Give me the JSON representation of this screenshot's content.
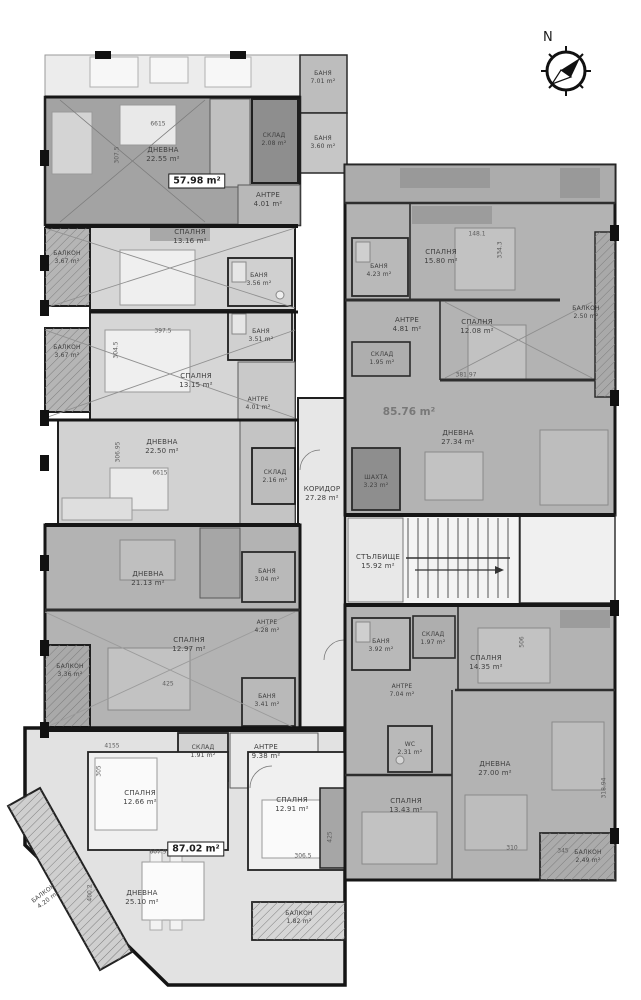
{
  "compass": {
    "label": "N"
  },
  "apartment_totals": [
    {
      "area": "57.98 m²"
    },
    {
      "area": "85.76 m²"
    },
    {
      "area": "87.02 m²"
    }
  ],
  "rooms": [
    {
      "name": "ДНЕВНА",
      "area": "22.55 m²"
    },
    {
      "name": "СКЛАД",
      "area": "2.08 m²"
    },
    {
      "name": "АНТРЕ",
      "area": "4.01 m²"
    },
    {
      "name": "БАНЯ",
      "area": "7.01 m²"
    },
    {
      "name": "БАНЯ",
      "area": "3.60 m²"
    },
    {
      "name": "БАЛКОН",
      "area": "3.67 m²"
    },
    {
      "name": "СПАЛНЯ",
      "area": "13.16 m²"
    },
    {
      "name": "БАНЯ",
      "area": "3.56 m²"
    },
    {
      "name": "БАНЯ",
      "area": "3.51 m²"
    },
    {
      "name": "БАЛКОН",
      "area": "3.67 m²"
    },
    {
      "name": "СПАЛНЯ",
      "area": "13.15 m²"
    },
    {
      "name": "АНТРЕ",
      "area": "4.01 m²"
    },
    {
      "name": "ДНЕВНА",
      "area": "22.50 m²"
    },
    {
      "name": "СКЛАД",
      "area": "2.16 m²"
    },
    {
      "name": "КОРИДОР",
      "area": "27.28 m²"
    },
    {
      "name": "БАНЯ",
      "area": "4.23 m²"
    },
    {
      "name": "СПАЛНЯ",
      "area": "15.80 m²"
    },
    {
      "name": "АНТРЕ",
      "area": "4.81 m²"
    },
    {
      "name": "СПАЛНЯ",
      "area": "12.08 m²"
    },
    {
      "name": "СКЛАД",
      "area": "1.95 m²"
    },
    {
      "name": "БАЛКОН",
      "area": "2.50 m²"
    },
    {
      "name": "ДНЕВНА",
      "area": "27.34 m²"
    },
    {
      "name": "ШАХТА",
      "area": "3.23 m²"
    },
    {
      "name": "СТЪЛБИЩЕ",
      "area": "15.92 m²"
    },
    {
      "name": "ДНЕВНА",
      "area": "21.13 m²"
    },
    {
      "name": "БАНЯ",
      "area": "3.04 m²"
    },
    {
      "name": "АНТРЕ",
      "area": "4.28 m²"
    },
    {
      "name": "СПАЛНЯ",
      "area": "12.97 m²"
    },
    {
      "name": "БАЛКОН",
      "area": "3.36 m²"
    },
    {
      "name": "БАНЯ",
      "area": "3.41 m²"
    },
    {
      "name": "СКЛАД",
      "area": "1.91 m²"
    },
    {
      "name": "АНТРЕ",
      "area": "9.38 m²"
    },
    {
      "name": "СПАЛНЯ",
      "area": "12.66 m²"
    },
    {
      "name": "ДНЕВНА",
      "area": "25.10 m²"
    },
    {
      "name": "БАЛКОН",
      "area": "4.20 m²"
    },
    {
      "name": "СПАЛНЯ",
      "area": "12.91 m²"
    },
    {
      "name": "БАЛКОН",
      "area": "1.82 m²"
    },
    {
      "name": "БАНЯ",
      "area": "3.92 m²"
    },
    {
      "name": "СКЛАД",
      "area": "1.97 m²"
    },
    {
      "name": "СПАЛНЯ",
      "area": "14.35 m²"
    },
    {
      "name": "АНТРЕ",
      "area": "7.04 m²"
    },
    {
      "name": "WC",
      "area": "2.31 m²"
    },
    {
      "name": "ДНЕВНА",
      "area": "27.00 m²"
    },
    {
      "name": "СПАЛНЯ",
      "area": "13.43 m²"
    },
    {
      "name": "БАЛКОН",
      "area": "2.49 m²"
    }
  ],
  "dims": [
    "6615",
    "307.5",
    "397.5",
    "304.5",
    "306.95",
    "6615",
    "425",
    "4155",
    "305",
    "607.9",
    "400.2",
    "425",
    "306.5",
    "148.1",
    "334.3",
    "381.97",
    "506",
    "310",
    "345",
    "318.94"
  ]
}
